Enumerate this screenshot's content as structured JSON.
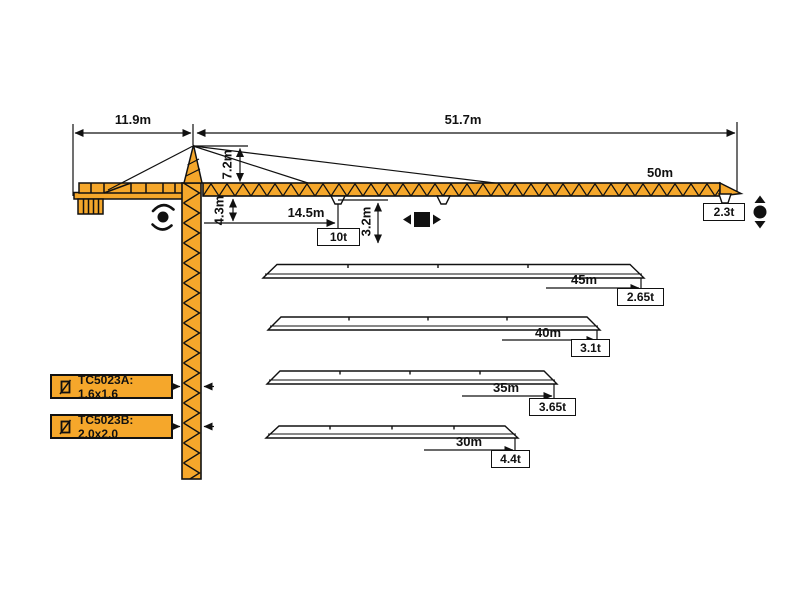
{
  "title": "Tower crane TC5023 working range diagram",
  "colors": {
    "crane_orange": "#F5A72B",
    "line_black": "#111111",
    "background": "#FFFFFF"
  },
  "dims": {
    "counter_jib": "11.9m",
    "total_jib": "51.7m",
    "head_height": "7.2m",
    "under_jib": "4.3m",
    "hook_drop": "3.2m",
    "max_load_radius": "14.5m",
    "full_jib": "50m"
  },
  "loads": {
    "max": "10t",
    "tip_50m": "2.3t"
  },
  "models": [
    {
      "name": "TC5023A: 1.6x1.6"
    },
    {
      "name": "TC5023B: 2.0x2.0"
    }
  ],
  "variants": [
    {
      "length": "45m",
      "tip_load": "2.65t"
    },
    {
      "length": "40m",
      "tip_load": "3.1t"
    },
    {
      "length": "35m",
      "tip_load": "3.65t"
    },
    {
      "length": "30m",
      "tip_load": "4.4t"
    }
  ],
  "icons": {
    "slewing_icon": "black dot with rotation arcs",
    "trolley_icon": "black square with left-right arrows",
    "hoist_icon": "black circle with up-down arrows",
    "mast_section_icon": "square with diagonal line"
  }
}
